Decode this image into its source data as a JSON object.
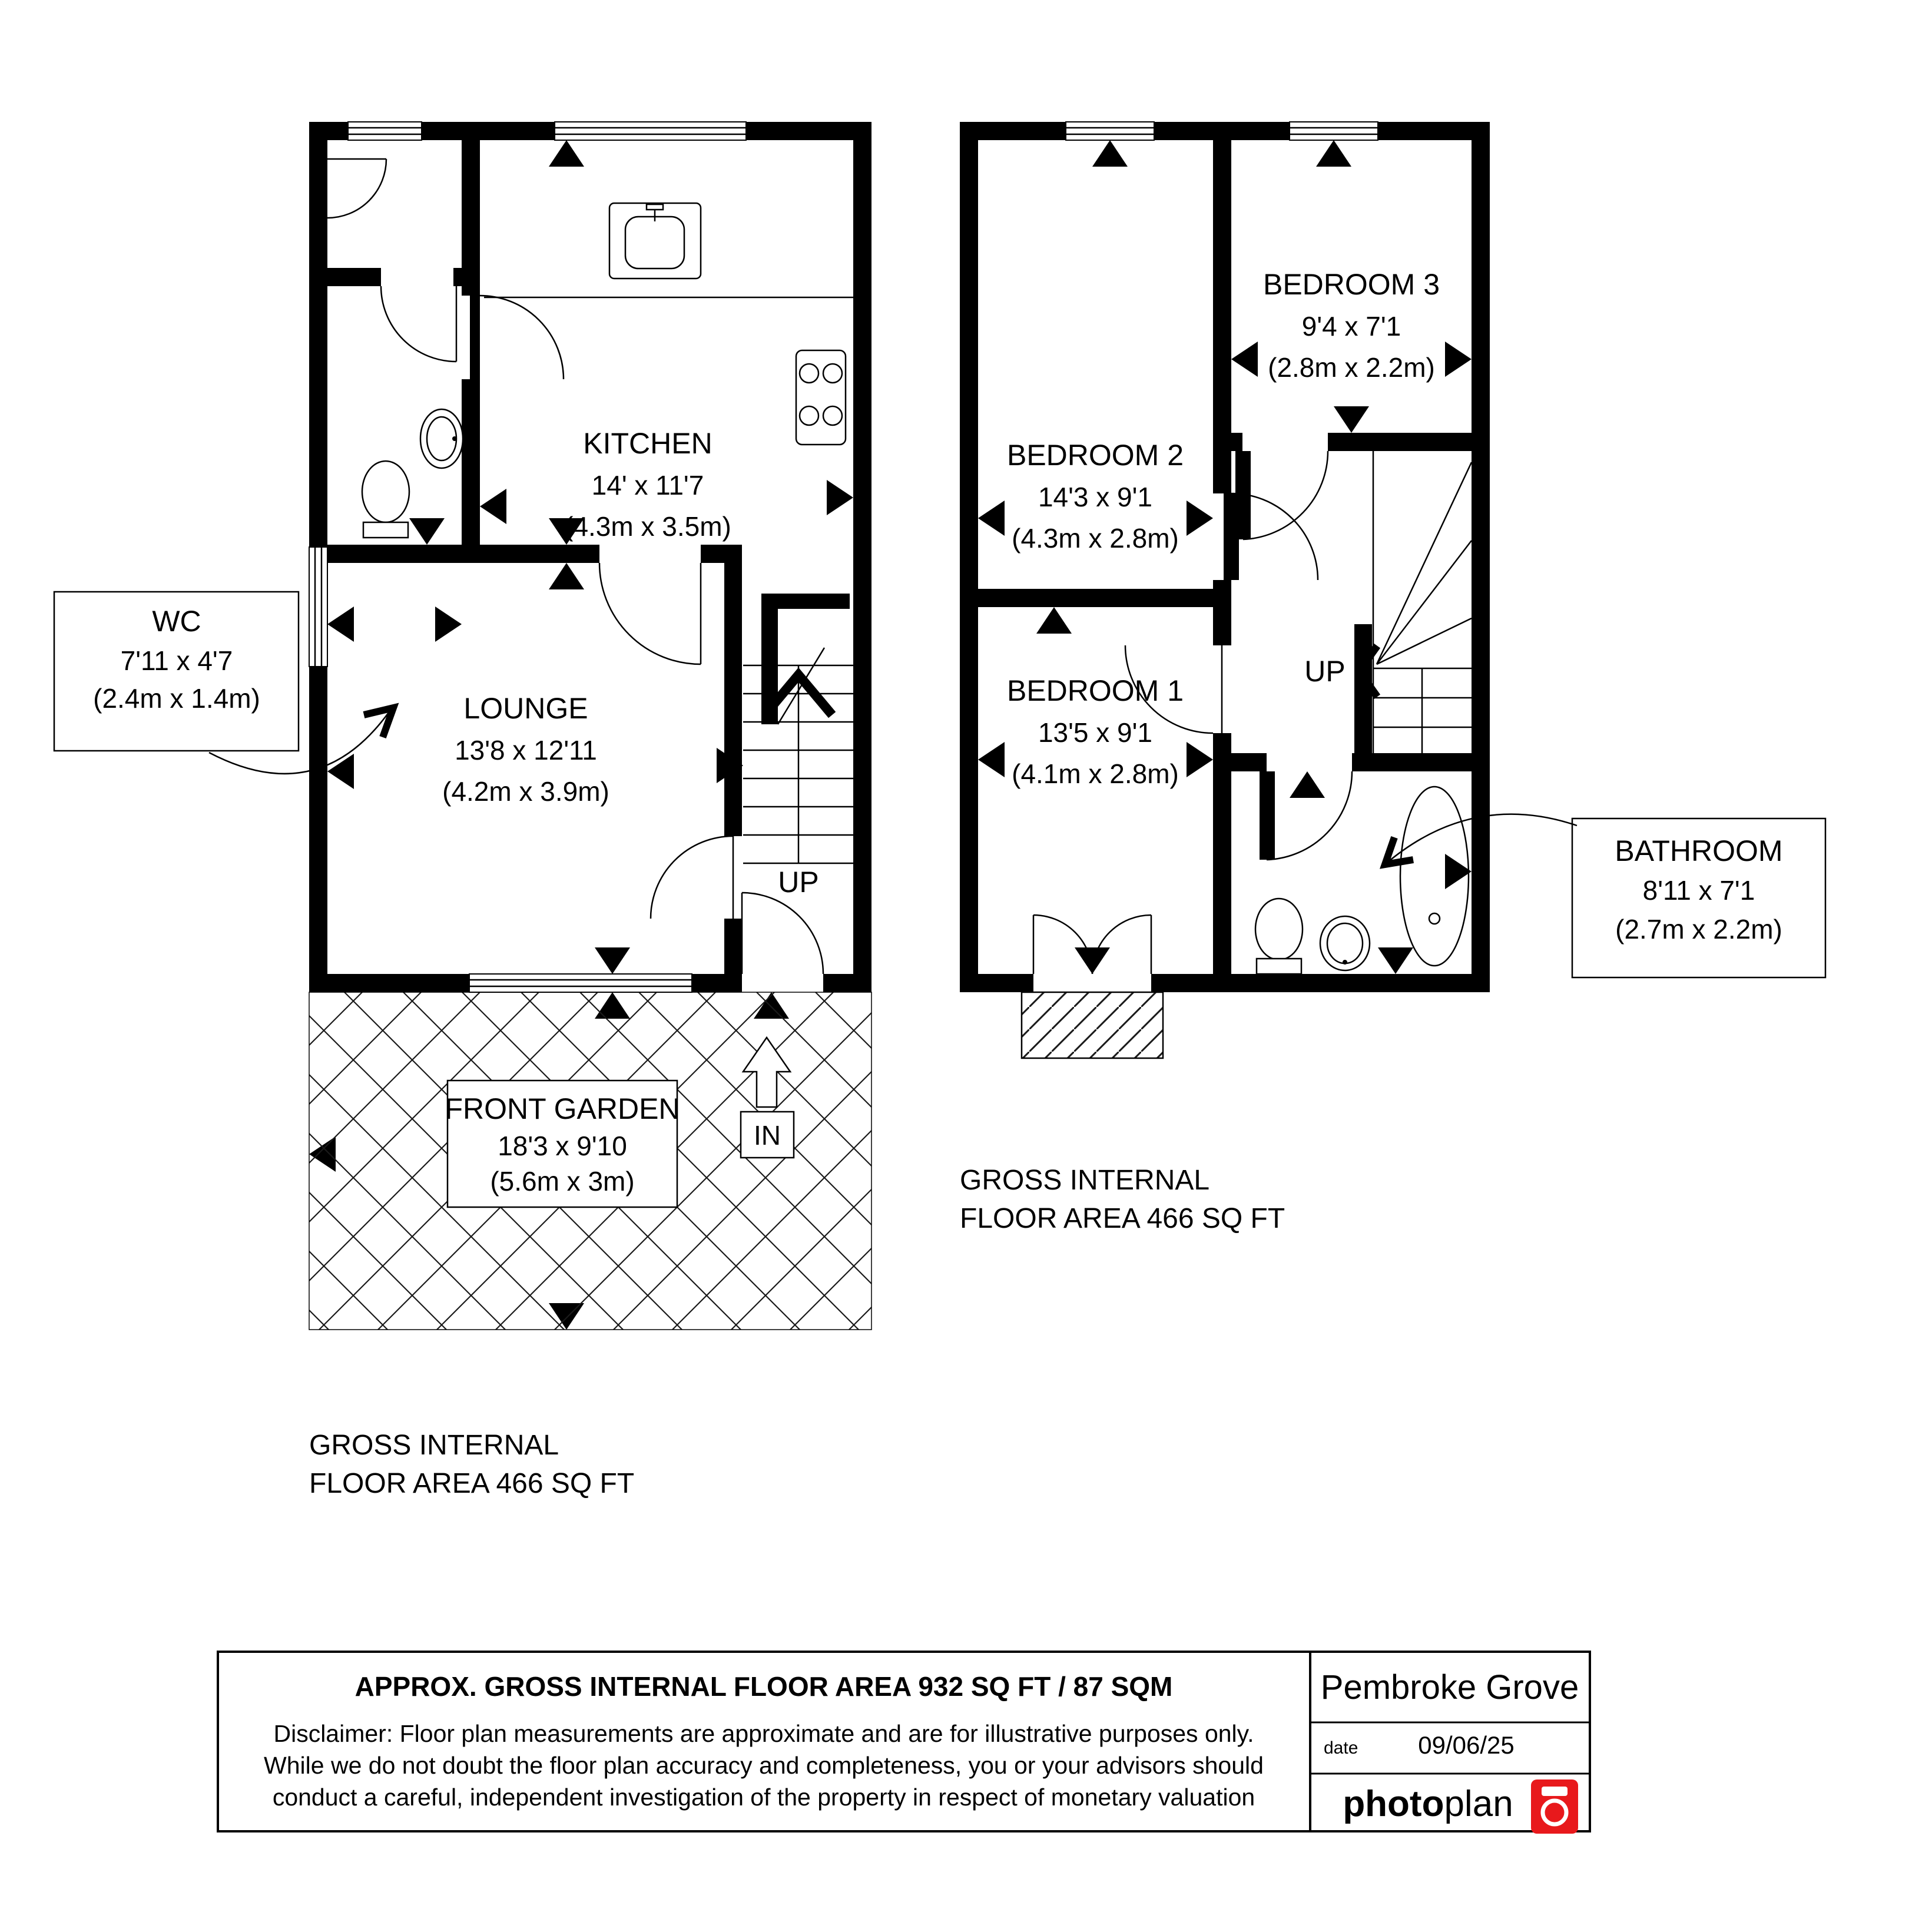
{
  "colors": {
    "wall": "#000000",
    "background": "#ffffff",
    "logo_red": "#e8191c"
  },
  "ground_floor": {
    "kitchen": {
      "name": "KITCHEN",
      "imperial": "14' x 11'7",
      "metric": "(4.3m x 3.5m)"
    },
    "lounge": {
      "name": "LOUNGE",
      "imperial": "13'8 x 12'11",
      "metric": "(4.2m x 3.9m)"
    },
    "wc": {
      "name": "WC",
      "imperial": "7'11 x 4'7",
      "metric": "(2.4m x 1.4m)"
    },
    "front_garden": {
      "name": "FRONT GARDEN",
      "imperial": "18'3 x 9'10",
      "metric": "(5.6m x 3m)"
    },
    "stairs_label": "UP",
    "entrance_label": "IN",
    "area_line1": "GROSS INTERNAL",
    "area_line2": "FLOOR AREA 466 SQ FT"
  },
  "first_floor": {
    "bedroom1": {
      "name": "BEDROOM 1",
      "imperial": "13'5 x 9'1",
      "metric": "(4.1m x 2.8m)"
    },
    "bedroom2": {
      "name": "BEDROOM 2",
      "imperial": "14'3 x 9'1",
      "metric": "(4.3m x 2.8m)"
    },
    "bedroom3": {
      "name": "BEDROOM 3",
      "imperial": "9'4 x 7'1",
      "metric": "(2.8m x 2.2m)"
    },
    "bathroom": {
      "name": "BATHROOM",
      "imperial": "8'11 x 7'1",
      "metric": "(2.7m x 2.2m)"
    },
    "stairs_label": "UP",
    "area_line1": "GROSS INTERNAL",
    "area_line2": "FLOOR AREA 466 SQ FT"
  },
  "footer": {
    "area_title": "APPROX. GROSS INTERNAL FLOOR AREA 932 SQ FT / 87 SQM",
    "disclaimer_line1": "Disclaimer: Floor plan measurements are approximate and are for illustrative purposes only.",
    "disclaimer_line2": "While we do not doubt the floor plan accuracy and completeness, you or your advisors should",
    "disclaimer_line3": "conduct a careful, independent investigation of the property in respect of monetary valuation",
    "property_name": "Pembroke Grove",
    "date_label": "date",
    "date_value": "09/06/25",
    "logo_bold": "photo",
    "logo_light": "plan"
  }
}
